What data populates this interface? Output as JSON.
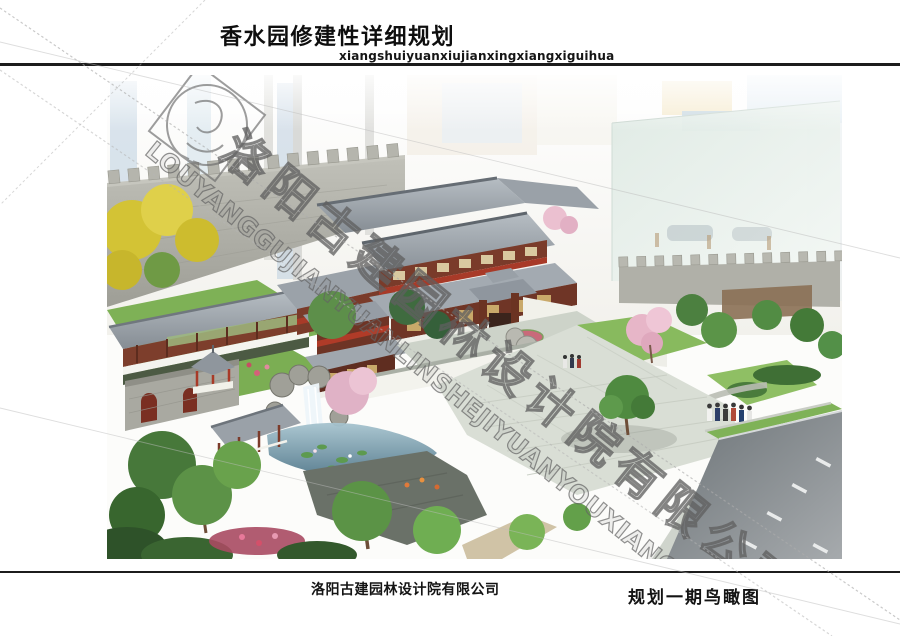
{
  "sheet": {
    "title": "香水园修建性详细规划",
    "pinyin": "xiangshuiyuanxiujianxingxiangxiguihua",
    "company": "洛阳古建园林设计院有限公司",
    "caption": "规划一期鸟瞰图"
  },
  "watermark": {
    "text_cn": "洛阳古建园林设计院有限公司",
    "text_en": "LOUYANGGUJIANYUANLINSHEJIYUANYOUXIANGONGSI"
  },
  "colors": {
    "rule_line": "#1c1c1c",
    "title_text": "#0e0e0e",
    "watermark_stroke": "#6f6f6f",
    "roof_gray": "#9aa1a8",
    "timber_red": "#7a3b2a",
    "city_wall_gray": "#aeaea6",
    "foliage_green": "#5c9247",
    "gingko_yellow": "#d6c437",
    "blossom_pink": "#e7b6c8",
    "water_blue": "#6f98ab",
    "plaza_gray": "#d9ded5",
    "road_gray": "#84898c"
  }
}
